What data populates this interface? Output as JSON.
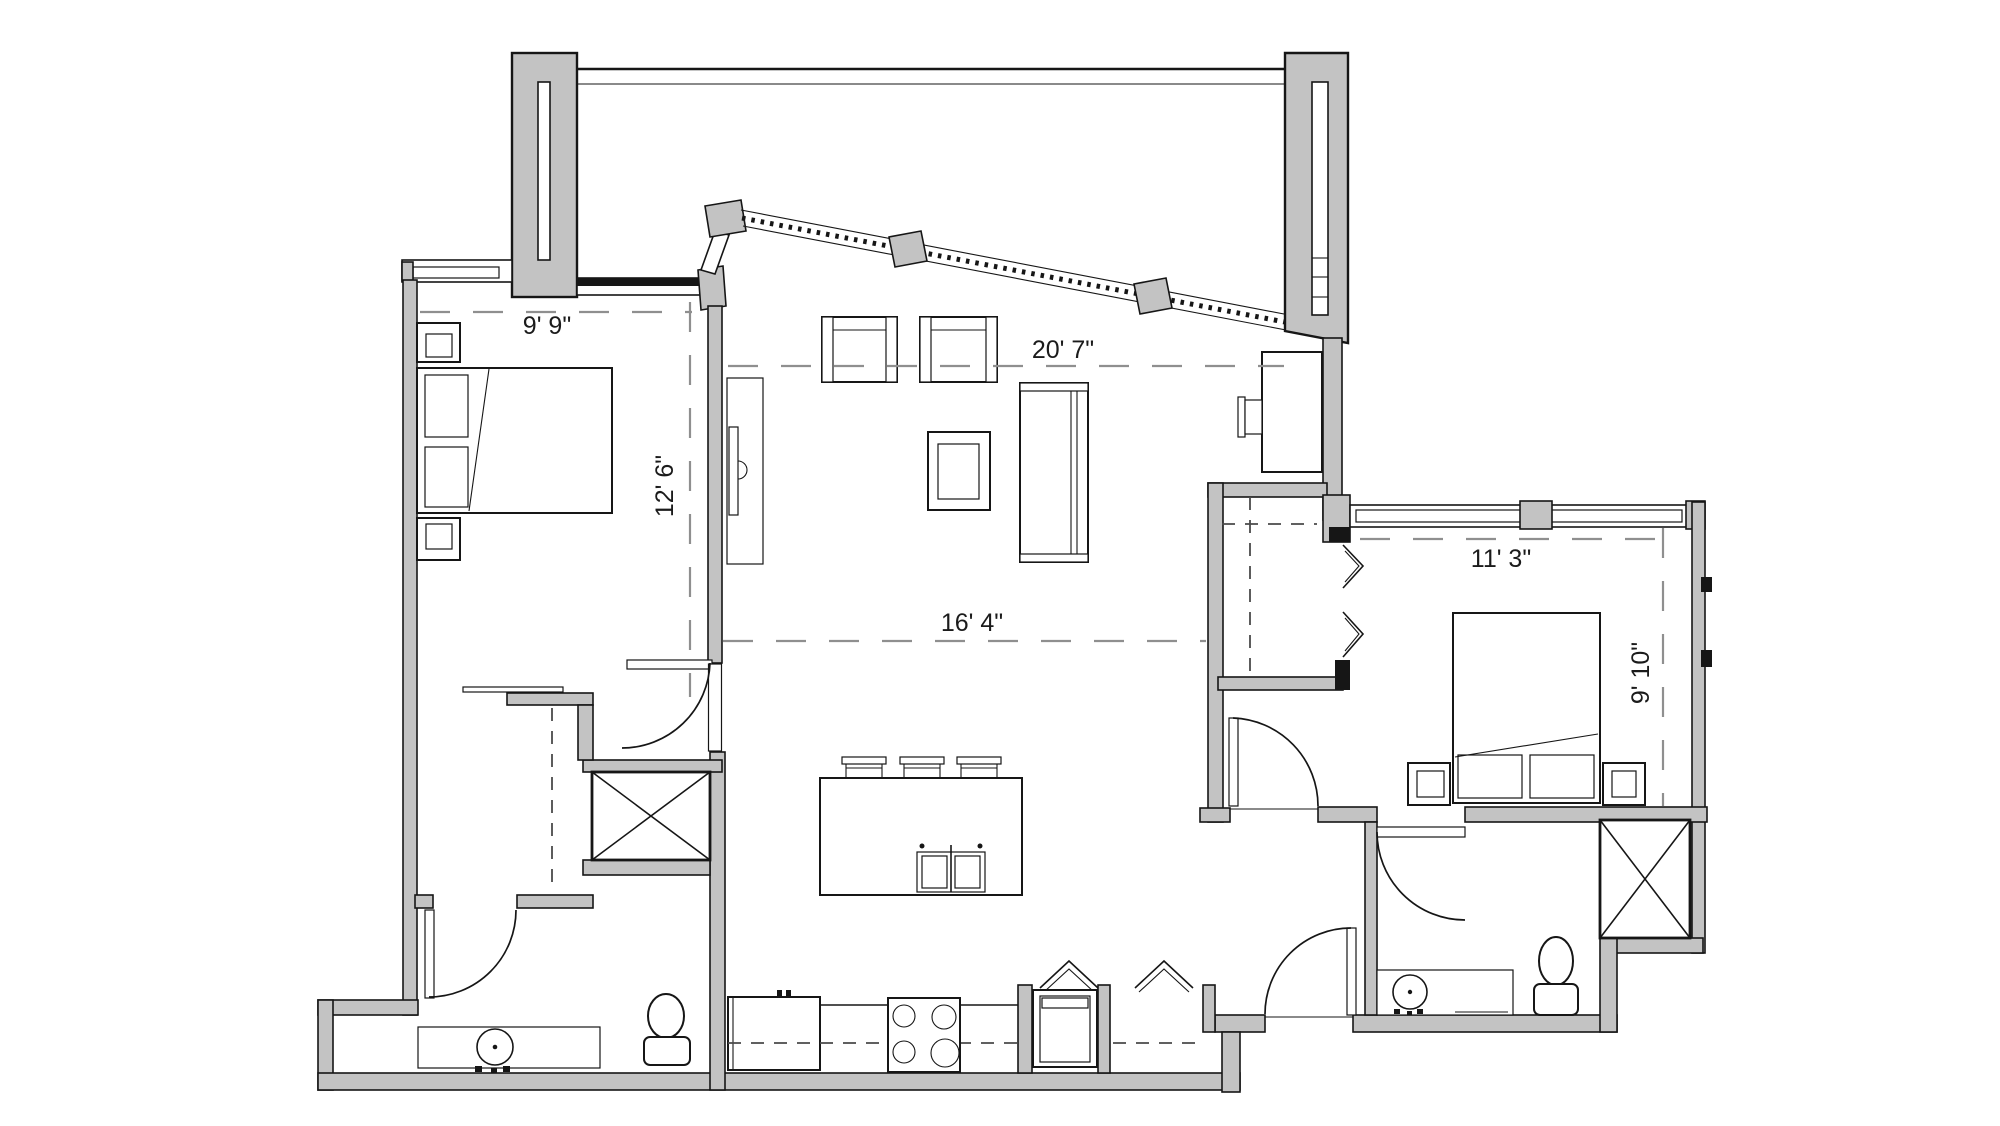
{
  "colors": {
    "wall": "#c3c3c3",
    "line": "#161616",
    "dash": "#8f8f8f",
    "bg": "#ffffff"
  },
  "dimensions": {
    "bedroom1_width": "9' 9\"",
    "bedroom1_depth": "12' 6\"",
    "living_width": "20' 7\"",
    "living_depth": "16' 4\"",
    "bedroom2_width": "11' 3\"",
    "bedroom2_depth": "9' 10\""
  }
}
